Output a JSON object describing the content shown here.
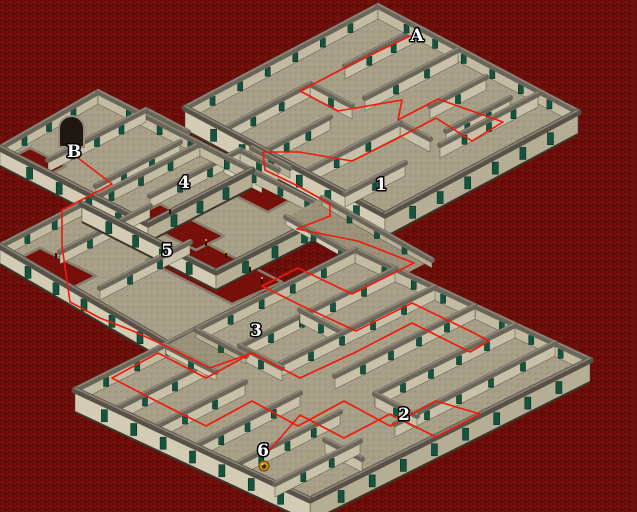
{
  "scene": {
    "width": 637,
    "height": 512,
    "bg": "#6c0f0b",
    "bg_dot_light": "#7c140f",
    "bg_dot_dark": "#4e0704"
  },
  "colors": {
    "floor": "#a89f88",
    "bridge_floor": "#9b9279",
    "hole": "#770f0b",
    "hole_edge": "#857f6c",
    "cap": "#6b665a",
    "cap_hi": "#8d8778",
    "cap_near": "#575248",
    "base": "#3a362c",
    "face_far": "#c2baa1",
    "face_inner": "#c8c0a8",
    "face_light": "#d3cbb3",
    "face_shade": "#b6ad95",
    "door": "#14543e",
    "door_frame": "#0a2f22",
    "route": "#ef1a0a",
    "label_fill": "#ffffff",
    "label_stroke": "#000000",
    "candle": "#2f1008",
    "flame": "#e09a35",
    "marker_outer": "#c8921c",
    "marker_ring": "#6f4c08",
    "marker_core": "#402d06",
    "marker_glint": "#ffe07a",
    "arch_fill": "#1f1712",
    "arch_frame": "#968d7a"
  },
  "structures": [
    {
      "id": "maze-1-building",
      "floors": [
        [
          [
            378,
            6
          ],
          [
            578,
            112
          ],
          [
            385,
            215
          ],
          [
            185,
            108
          ]
        ]
      ],
      "walls": [
        [
          185,
          108,
          378,
          6,
          13,
          "F"
        ],
        [
          378,
          6,
          578,
          112,
          13,
          "F"
        ],
        [
          225,
          129,
          310,
          84,
          13,
          "I"
        ],
        [
          345,
          66,
          418,
          28,
          13,
          "I"
        ],
        [
          265,
          151,
          330,
          117,
          13,
          "I"
        ],
        [
          365,
          98,
          458,
          50,
          13,
          "I"
        ],
        [
          305,
          172,
          400,
          123,
          13,
          "I"
        ],
        [
          430,
          106,
          486,
          77,
          13,
          "I"
        ],
        [
          446,
          131,
          510,
          98,
          13,
          "I"
        ],
        [
          345,
          194,
          405,
          163,
          13,
          "I"
        ],
        [
          440,
          145,
          538,
          94,
          13,
          "I"
        ],
        [
          310,
          84,
          352,
          106,
          13,
          "I"
        ],
        [
          400,
          123,
          430,
          139,
          13,
          "I"
        ],
        [
          185,
          108,
          385,
          215,
          22,
          "L"
        ],
        [
          385,
          215,
          578,
          112,
          22,
          "R"
        ]
      ],
      "holes": [],
      "candles": []
    },
    {
      "id": "left-structure",
      "floors": [
        [
          [
            98,
            92
          ],
          [
            252,
            170
          ],
          [
            148,
            224
          ],
          [
            0,
            148
          ]
        ],
        [
          [
            200,
            144
          ],
          [
            334,
            212
          ],
          [
            216,
            272
          ],
          [
            82,
            204
          ]
        ],
        [
          [
            82,
            204
          ],
          [
            262,
            296
          ],
          [
            168,
            344
          ],
          [
            0,
            246
          ]
        ],
        [
          [
            252,
            148
          ],
          [
            290,
            168
          ],
          [
            262,
            183
          ],
          [
            224,
            163
          ]
        ]
      ],
      "walls": [
        [
          0,
          148,
          98,
          92,
          12,
          "F"
        ],
        [
          98,
          92,
          252,
          170,
          12,
          "F"
        ],
        [
          48,
          160,
          146,
          110,
          12,
          "I"
        ],
        [
          96,
          186,
          180,
          142,
          12,
          "I"
        ],
        [
          146,
          110,
          188,
          132,
          12,
          "I"
        ],
        [
          0,
          148,
          148,
          224,
          18,
          "L"
        ],
        [
          148,
          224,
          252,
          170,
          18,
          "R"
        ],
        [
          82,
          204,
          200,
          144,
          12,
          "F"
        ],
        [
          200,
          144,
          334,
          212,
          12,
          "F"
        ],
        [
          150,
          196,
          240,
          150,
          12,
          "I"
        ],
        [
          240,
          150,
          278,
          170,
          12,
          "I"
        ],
        [
          82,
          204,
          216,
          272,
          18,
          "L"
        ],
        [
          216,
          272,
          334,
          212,
          18,
          "R"
        ],
        [
          0,
          246,
          82,
          204,
          12,
          "F"
        ],
        [
          60,
          252,
          150,
          206,
          12,
          "I"
        ],
        [
          100,
          288,
          190,
          242,
          12,
          "I"
        ],
        [
          0,
          246,
          168,
          344,
          18,
          "L"
        ],
        [
          168,
          344,
          262,
          296,
          18,
          "R"
        ],
        [
          252,
          148,
          290,
          168,
          10,
          "R"
        ],
        [
          224,
          163,
          262,
          183,
          10,
          "L"
        ]
      ],
      "holes": [
        [
          [
            196,
            238
          ],
          [
            282,
            282
          ],
          [
            232,
            304
          ],
          [
            146,
            260
          ]
        ],
        [
          [
            160,
            204
          ],
          [
            224,
            236
          ],
          [
            196,
            250
          ],
          [
            132,
            218
          ]
        ],
        [
          [
            40,
            248
          ],
          [
            96,
            276
          ],
          [
            64,
            292
          ],
          [
            8,
            264
          ]
        ],
        [
          [
            30,
            148
          ],
          [
            66,
            166
          ],
          [
            46,
            176
          ],
          [
            10,
            158
          ]
        ],
        [
          [
            246,
            178
          ],
          [
            290,
            200
          ],
          [
            268,
            212
          ],
          [
            224,
            190
          ]
        ]
      ],
      "candles": [
        [
          206,
          246
        ],
        [
          226,
          258
        ],
        [
          250,
          272
        ],
        [
          170,
          214
        ],
        [
          56,
          258
        ],
        [
          262,
          284
        ]
      ]
    },
    {
      "id": "bridge-east",
      "floors": [
        [
          [
            322,
            198
          ],
          [
            432,
            260
          ],
          [
            396,
            279
          ],
          [
            286,
            217
          ]
        ]
      ],
      "walls": [
        [
          322,
          198,
          432,
          260,
          8,
          "R"
        ],
        [
          286,
          217,
          396,
          279,
          8,
          "L"
        ]
      ],
      "holes": [],
      "candles": []
    },
    {
      "id": "maze-2-building",
      "floors": [
        [
          [
            355,
            250
          ],
          [
            590,
            360
          ],
          [
            310,
            500
          ],
          [
            75,
            390
          ]
        ]
      ],
      "walls": [
        [
          75,
          390,
          355,
          250,
          13,
          "F"
        ],
        [
          355,
          250,
          590,
          360,
          13,
          "F"
        ],
        [
          115,
          409,
          205,
          364,
          13,
          "I"
        ],
        [
          240,
          346,
          395,
          269,
          13,
          "I"
        ],
        [
          155,
          427,
          245,
          382,
          13,
          "I"
        ],
        [
          280,
          364,
          435,
          287,
          13,
          "I"
        ],
        [
          195,
          446,
          300,
          393,
          13,
          "I"
        ],
        [
          335,
          376,
          475,
          306,
          13,
          "I"
        ],
        [
          235,
          465,
          340,
          412,
          13,
          "I"
        ],
        [
          375,
          394,
          515,
          325,
          13,
          "I"
        ],
        [
          275,
          484,
          360,
          441,
          13,
          "I"
        ],
        [
          395,
          424,
          555,
          343,
          13,
          "I"
        ],
        [
          240,
          346,
          282,
          368,
          13,
          "I"
        ],
        [
          375,
          394,
          417,
          416,
          13,
          "I"
        ],
        [
          325,
          440,
          362,
          459,
          13,
          "I"
        ],
        [
          300,
          310,
          342,
          332,
          13,
          "I"
        ],
        [
          75,
          390,
          310,
          500,
          22,
          "L"
        ],
        [
          310,
          500,
          590,
          360,
          22,
          "R"
        ]
      ],
      "holes": [],
      "candles": []
    },
    {
      "id": "bridge-west",
      "floors": [
        [
          [
            196,
            330
          ],
          [
            246,
            356
          ],
          [
            216,
            372
          ],
          [
            166,
            346
          ]
        ]
      ],
      "walls": [
        [
          196,
          330,
          246,
          356,
          8,
          "R"
        ],
        [
          166,
          346,
          216,
          372,
          8,
          "L"
        ]
      ],
      "holes": [],
      "candles": []
    }
  ],
  "arch": {
    "x": 59,
    "y": 116,
    "w": 25,
    "h": 31
  },
  "route": {
    "width": 1.6,
    "segments": [
      [
        [
          410,
          36
        ],
        [
          352,
          64
        ],
        [
          300,
          91
        ],
        [
          338,
          111
        ],
        [
          402,
          100
        ],
        [
          398,
          120
        ],
        [
          438,
          99
        ],
        [
          503,
          122
        ],
        [
          472,
          141
        ],
        [
          436,
          118
        ],
        [
          398,
          138
        ],
        [
          352,
          161
        ],
        [
          299,
          152
        ],
        [
          263,
          152
        ],
        [
          265,
          170
        ],
        [
          298,
          186
        ],
        [
          330,
          204
        ],
        [
          330,
          216
        ],
        [
          297,
          229
        ],
        [
          358,
          241
        ],
        [
          414,
          263
        ],
        [
          352,
          294
        ],
        [
          298,
          268
        ],
        [
          262,
          286
        ],
        [
          300,
          305
        ],
        [
          356,
          331
        ],
        [
          412,
          303
        ],
        [
          470,
          331
        ],
        [
          489,
          341
        ],
        [
          470,
          352
        ],
        [
          412,
          323
        ],
        [
          356,
          352
        ],
        [
          300,
          378
        ],
        [
          252,
          353
        ],
        [
          206,
          378
        ],
        [
          158,
          353
        ],
        [
          112,
          378
        ],
        [
          158,
          402
        ],
        [
          206,
          426
        ],
        [
          252,
          401
        ],
        [
          298,
          426
        ],
        [
          344,
          401
        ],
        [
          390,
          426
        ],
        [
          436,
          401
        ],
        [
          480,
          414
        ],
        [
          436,
          437
        ],
        [
          390,
          414
        ],
        [
          344,
          438
        ],
        [
          300,
          415
        ],
        [
          268,
          452
        ]
      ],
      [
        [
          78,
          158
        ],
        [
          112,
          184
        ],
        [
          62,
          210
        ],
        [
          62,
          246
        ],
        [
          70,
          302
        ],
        [
          100,
          318
        ],
        [
          133,
          331
        ],
        [
          168,
          347
        ],
        [
          210,
          368
        ],
        [
          252,
          353
        ]
      ]
    ]
  },
  "labels": [
    {
      "id": "A",
      "text": "A",
      "x": 417,
      "y": 41
    },
    {
      "id": "B",
      "text": "B",
      "x": 74,
      "y": 157
    },
    {
      "id": "1",
      "text": "1",
      "x": 381,
      "y": 190
    },
    {
      "id": "2",
      "text": "2",
      "x": 404,
      "y": 420
    },
    {
      "id": "3",
      "text": "3",
      "x": 256,
      "y": 336
    },
    {
      "id": "4",
      "text": "4",
      "x": 184,
      "y": 188
    },
    {
      "id": "5",
      "text": "5",
      "x": 167,
      "y": 256
    },
    {
      "id": "6",
      "text": "6",
      "x": 263,
      "y": 456
    }
  ],
  "marker": {
    "x": 264,
    "y": 466,
    "r": 5
  }
}
